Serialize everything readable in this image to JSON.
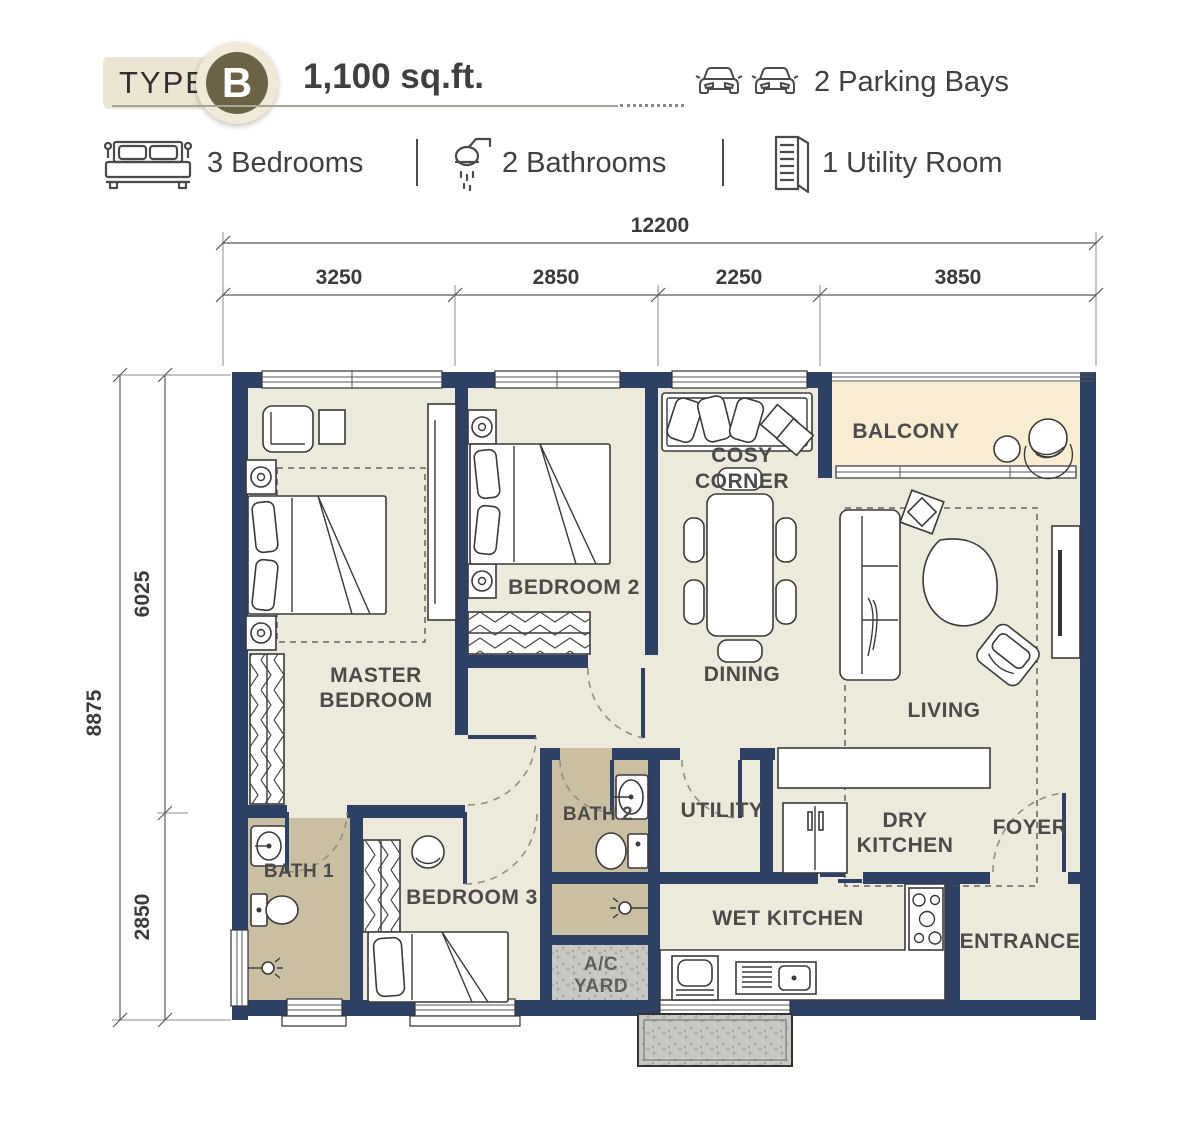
{
  "header": {
    "type_label": "TYPE",
    "type_letter": "B",
    "area": "1,100 sq.ft.",
    "parking_label": "2 Parking Bays",
    "parking_icon": "car-icon",
    "features": [
      {
        "icon": "bed-icon",
        "label": "3 Bedrooms"
      },
      {
        "icon": "shower-icon",
        "label": "2 Bathrooms"
      },
      {
        "icon": "door-icon",
        "label": "1 Utility Room"
      }
    ]
  },
  "dimensions": {
    "top_total": "12200",
    "top_segments": [
      "3250",
      "2850",
      "2250",
      "3850"
    ],
    "left_total": "8875",
    "left_segments": [
      "6025",
      "2850"
    ]
  },
  "rooms": {
    "master_bedroom": {
      "line1": "MASTER",
      "line2": "BEDROOM"
    },
    "bedroom2": {
      "label": "BEDROOM 2"
    },
    "cosy_corner": {
      "line1": "COSY",
      "line2": "CORNER"
    },
    "balcony": {
      "label": "BALCONY"
    },
    "dining": {
      "label": "DINING"
    },
    "living": {
      "label": "LIVING"
    },
    "bath2": {
      "label": "BATH 2"
    },
    "utility": {
      "label": "UTILITY"
    },
    "dry_kitchen": {
      "line1": "DRY",
      "line2": "KITCHEN"
    },
    "foyer": {
      "label": "FOYER"
    },
    "bath1": {
      "label": "BATH 1"
    },
    "bedroom3": {
      "label": "BEDROOM 3"
    },
    "wet_kitchen": {
      "label": "WET KITCHEN"
    },
    "entrance": {
      "label": "ENTRANCE"
    },
    "ac_yard": {
      "line1": "A/C",
      "line2": "YARD"
    }
  },
  "colors": {
    "wall": "#2E4164",
    "floor_main": "#EDE9DB",
    "floor_bath": "#CBBFA3",
    "floor_balcony": "#F8EDD3",
    "concrete": "#C9C7C1",
    "badge_circle": "#6C6346",
    "badge_pill": "#ECE5D3",
    "text_dark": "#3F4041",
    "room_label": "#4B4B4B"
  }
}
